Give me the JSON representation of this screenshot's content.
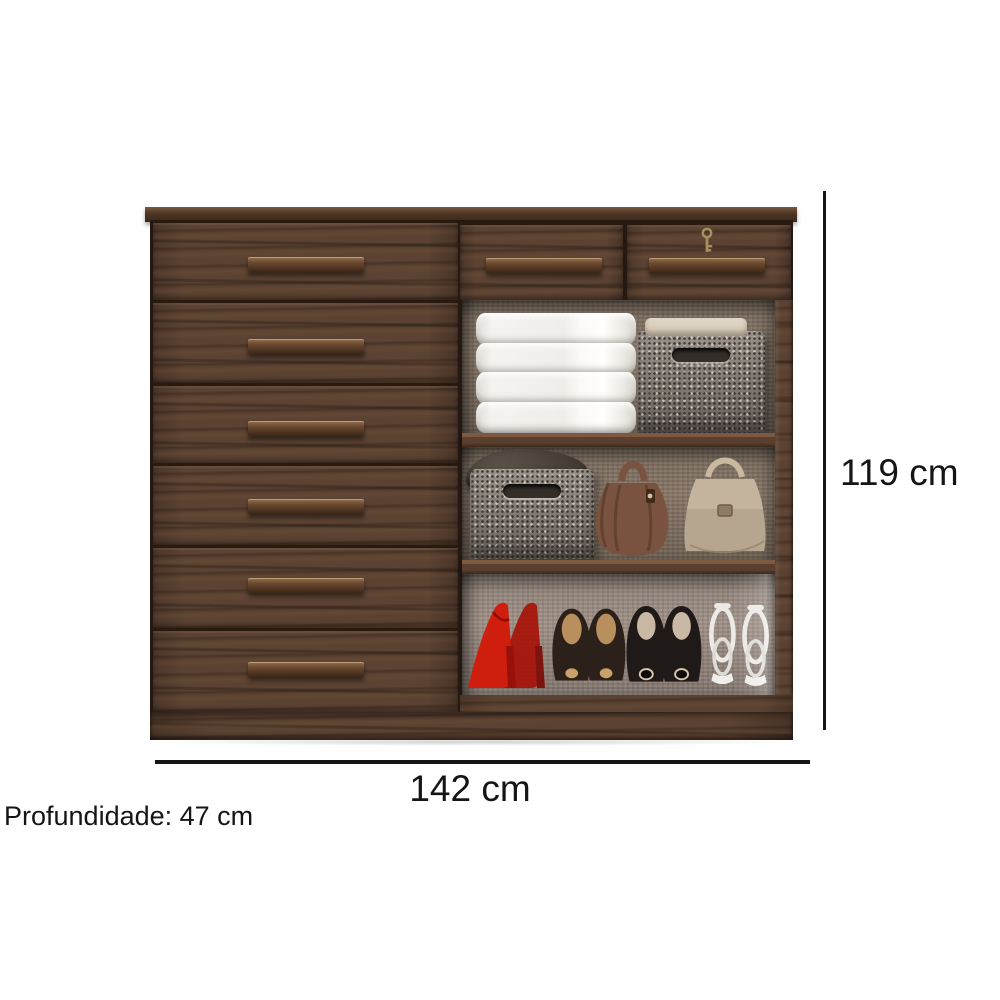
{
  "annotations": {
    "height": "119 cm",
    "width": "142 cm",
    "depth": "Profundidade: 47 cm"
  },
  "colors": {
    "bg": "#ffffff",
    "wood": "#5b4232",
    "wood_dark": "#3a2818",
    "wood_light": "#7a5a40",
    "line": "#151515",
    "interior": "#8a7a6a",
    "interior_light": "#a3948a",
    "towel": "#f4f3f0",
    "basket": "#8b8178",
    "bag_brown": "#7a5340",
    "bag_beige": "#b7a68f",
    "scarf": "#463e35",
    "shoe_red": "#d01e0e",
    "shoe_brown": "#2b211a",
    "shoe_black": "#1f1a17",
    "sandal_white": "#eceae6",
    "key_gold": "#a8905e"
  },
  "objects": {
    "left_drawer_count": 6,
    "top_drawer_count": 2,
    "lock": "key-icon",
    "shelf_top": [
      "folded-white-towels",
      "fabric-storage-basket"
    ],
    "shelf_middle": [
      "dark-scarf",
      "fabric-storage-basket",
      "brown-leather-bag",
      "beige-handbag"
    ],
    "shelf_bottom": [
      "red-pumps",
      "brown-peep-toe-heels",
      "black-pumps",
      "white-strappy-sandals"
    ]
  }
}
